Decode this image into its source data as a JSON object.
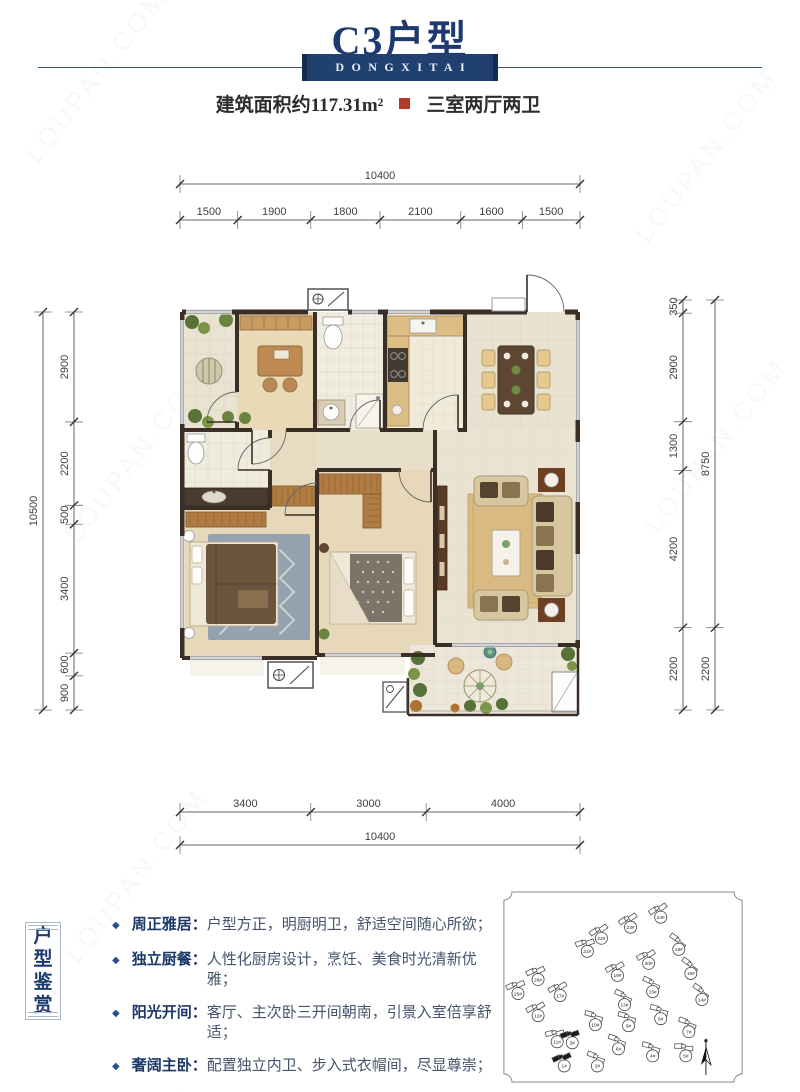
{
  "header": {
    "title": "C3户型",
    "brand": "DONGXITAI",
    "area_label": "建筑面积约117.31m²",
    "layout_label": "三室两厅两卫",
    "accent_navy": "#20406f",
    "accent_red": "#b23b28"
  },
  "dimensions": {
    "top_total": [
      "10400"
    ],
    "top_segments": [
      "1500",
      "1900",
      "1800",
      "2100",
      "1600",
      "1500"
    ],
    "left_total": [
      "10500"
    ],
    "left_segments": [
      "2900",
      "2200",
      "500",
      "3400",
      "600",
      "900"
    ],
    "right_inner": [
      "350",
      "2900",
      "1300",
      "4200",
      "2200"
    ],
    "right_outer": [
      "8750",
      "2200"
    ],
    "bottom_segments": [
      "3400",
      "3000",
      "4000"
    ],
    "bottom_total": [
      "10400"
    ]
  },
  "features": {
    "section_title": "户型鉴赏",
    "bullet": "◆",
    "items": [
      {
        "label": "周正雅居：",
        "text": "户型方正，明厨明卫，舒适空间随心所欲；"
      },
      {
        "label": "独立厨餐：",
        "text": "人性化厨房设计，烹饪、美食时光清新优雅；"
      },
      {
        "label": "阳光开间：",
        "text": "客厅、主次卧三开间朝南，引景入室倍享舒适；"
      },
      {
        "label": "奢阔主卧：",
        "text": "配置独立内卫、步入式衣帽间，尽显尊崇；"
      },
      {
        "label": "阔景阳台：",
        "text": "约4m南向阳台连接客厅，纵享自然生活。"
      }
    ]
  },
  "siteplan": {
    "buildings": [
      {
        "x": 158,
        "y": 22,
        "r": -35,
        "label": "24#"
      },
      {
        "x": 128,
        "y": 32,
        "r": -35,
        "label": "23#"
      },
      {
        "x": 99,
        "y": 43,
        "r": -35,
        "label": "22#"
      },
      {
        "x": 85,
        "y": 56,
        "r": -20,
        "label": "21#"
      },
      {
        "x": 176,
        "y": 54,
        "r": 35,
        "label": "18#"
      },
      {
        "x": 188,
        "y": 78,
        "r": 35,
        "label": "16#"
      },
      {
        "x": 199,
        "y": 104,
        "r": 35,
        "label": "14#"
      },
      {
        "x": 186,
        "y": 136,
        "r": 20,
        "label": "7#"
      },
      {
        "x": 146,
        "y": 68,
        "r": -30,
        "label": "20#"
      },
      {
        "x": 115,
        "y": 80,
        "r": -30,
        "label": "19#"
      },
      {
        "x": 150,
        "y": 96,
        "r": 25,
        "label": "15#"
      },
      {
        "x": 122,
        "y": 109,
        "r": 25,
        "label": "13#"
      },
      {
        "x": 36,
        "y": 84,
        "r": -25,
        "label": "26#"
      },
      {
        "x": 16,
        "y": 98,
        "r": -25,
        "label": "25#"
      },
      {
        "x": 58,
        "y": 100,
        "r": -30,
        "label": "17#"
      },
      {
        "x": 36,
        "y": 120,
        "r": -30,
        "label": "12#"
      },
      {
        "x": 93,
        "y": 129,
        "r": 15,
        "label": "10#"
      },
      {
        "x": 126,
        "y": 130,
        "r": 15,
        "label": "9#"
      },
      {
        "x": 158,
        "y": 123,
        "r": 15,
        "label": "8#"
      },
      {
        "x": 150,
        "y": 160,
        "r": 15,
        "label": "4#"
      },
      {
        "x": 55,
        "y": 146,
        "r": -15,
        "label": "11#"
      },
      {
        "x": 116,
        "y": 153,
        "r": 20,
        "label": "6#"
      },
      {
        "x": 183,
        "y": 160,
        "r": 0,
        "label": "5#"
      },
      {
        "x": 95,
        "y": 170,
        "r": 20,
        "label": "2#"
      },
      {
        "x": 70,
        "y": 147,
        "r": -20,
        "label": "3#",
        "hl": true
      },
      {
        "x": 62,
        "y": 170,
        "r": -25,
        "label": "1#",
        "hl": true
      }
    ]
  }
}
